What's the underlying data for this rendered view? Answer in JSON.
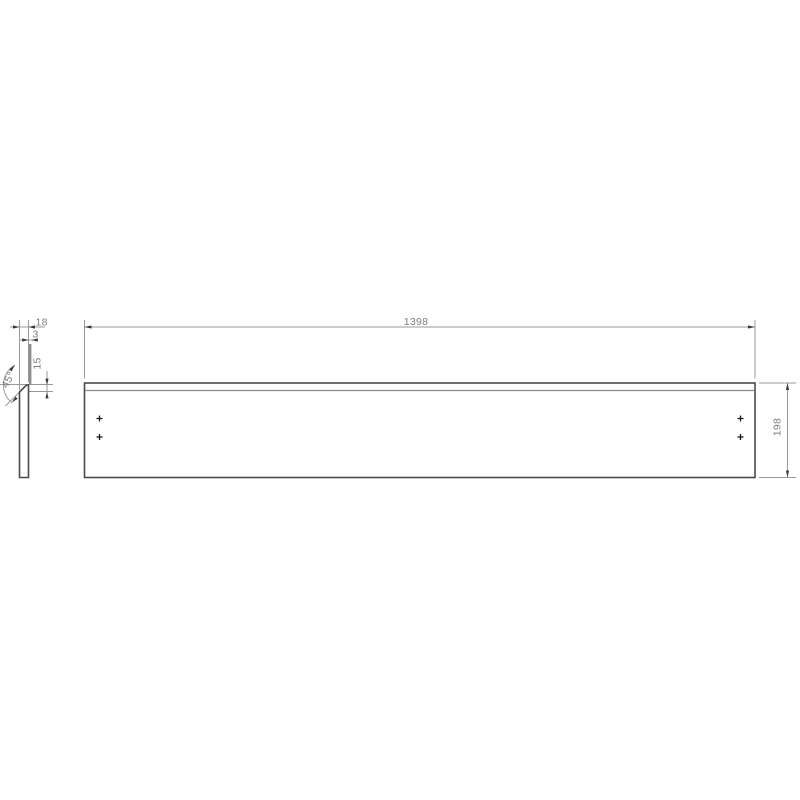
{
  "drawing": {
    "front_view": {
      "length_label": "1398",
      "height_label": "198"
    },
    "side_view": {
      "thickness_label": "18",
      "top_lip_label": "3",
      "chamfer_height_label": "15",
      "chamfer_angle_label": "45°"
    },
    "colors": {
      "background": "#ffffff",
      "outline": "#4a4a4a",
      "dimension": "#999999",
      "reference": "#8c8c8c",
      "arrow": "#3a3a3a",
      "text": "#7d7d7d",
      "marker": "#1a1a1a"
    }
  }
}
